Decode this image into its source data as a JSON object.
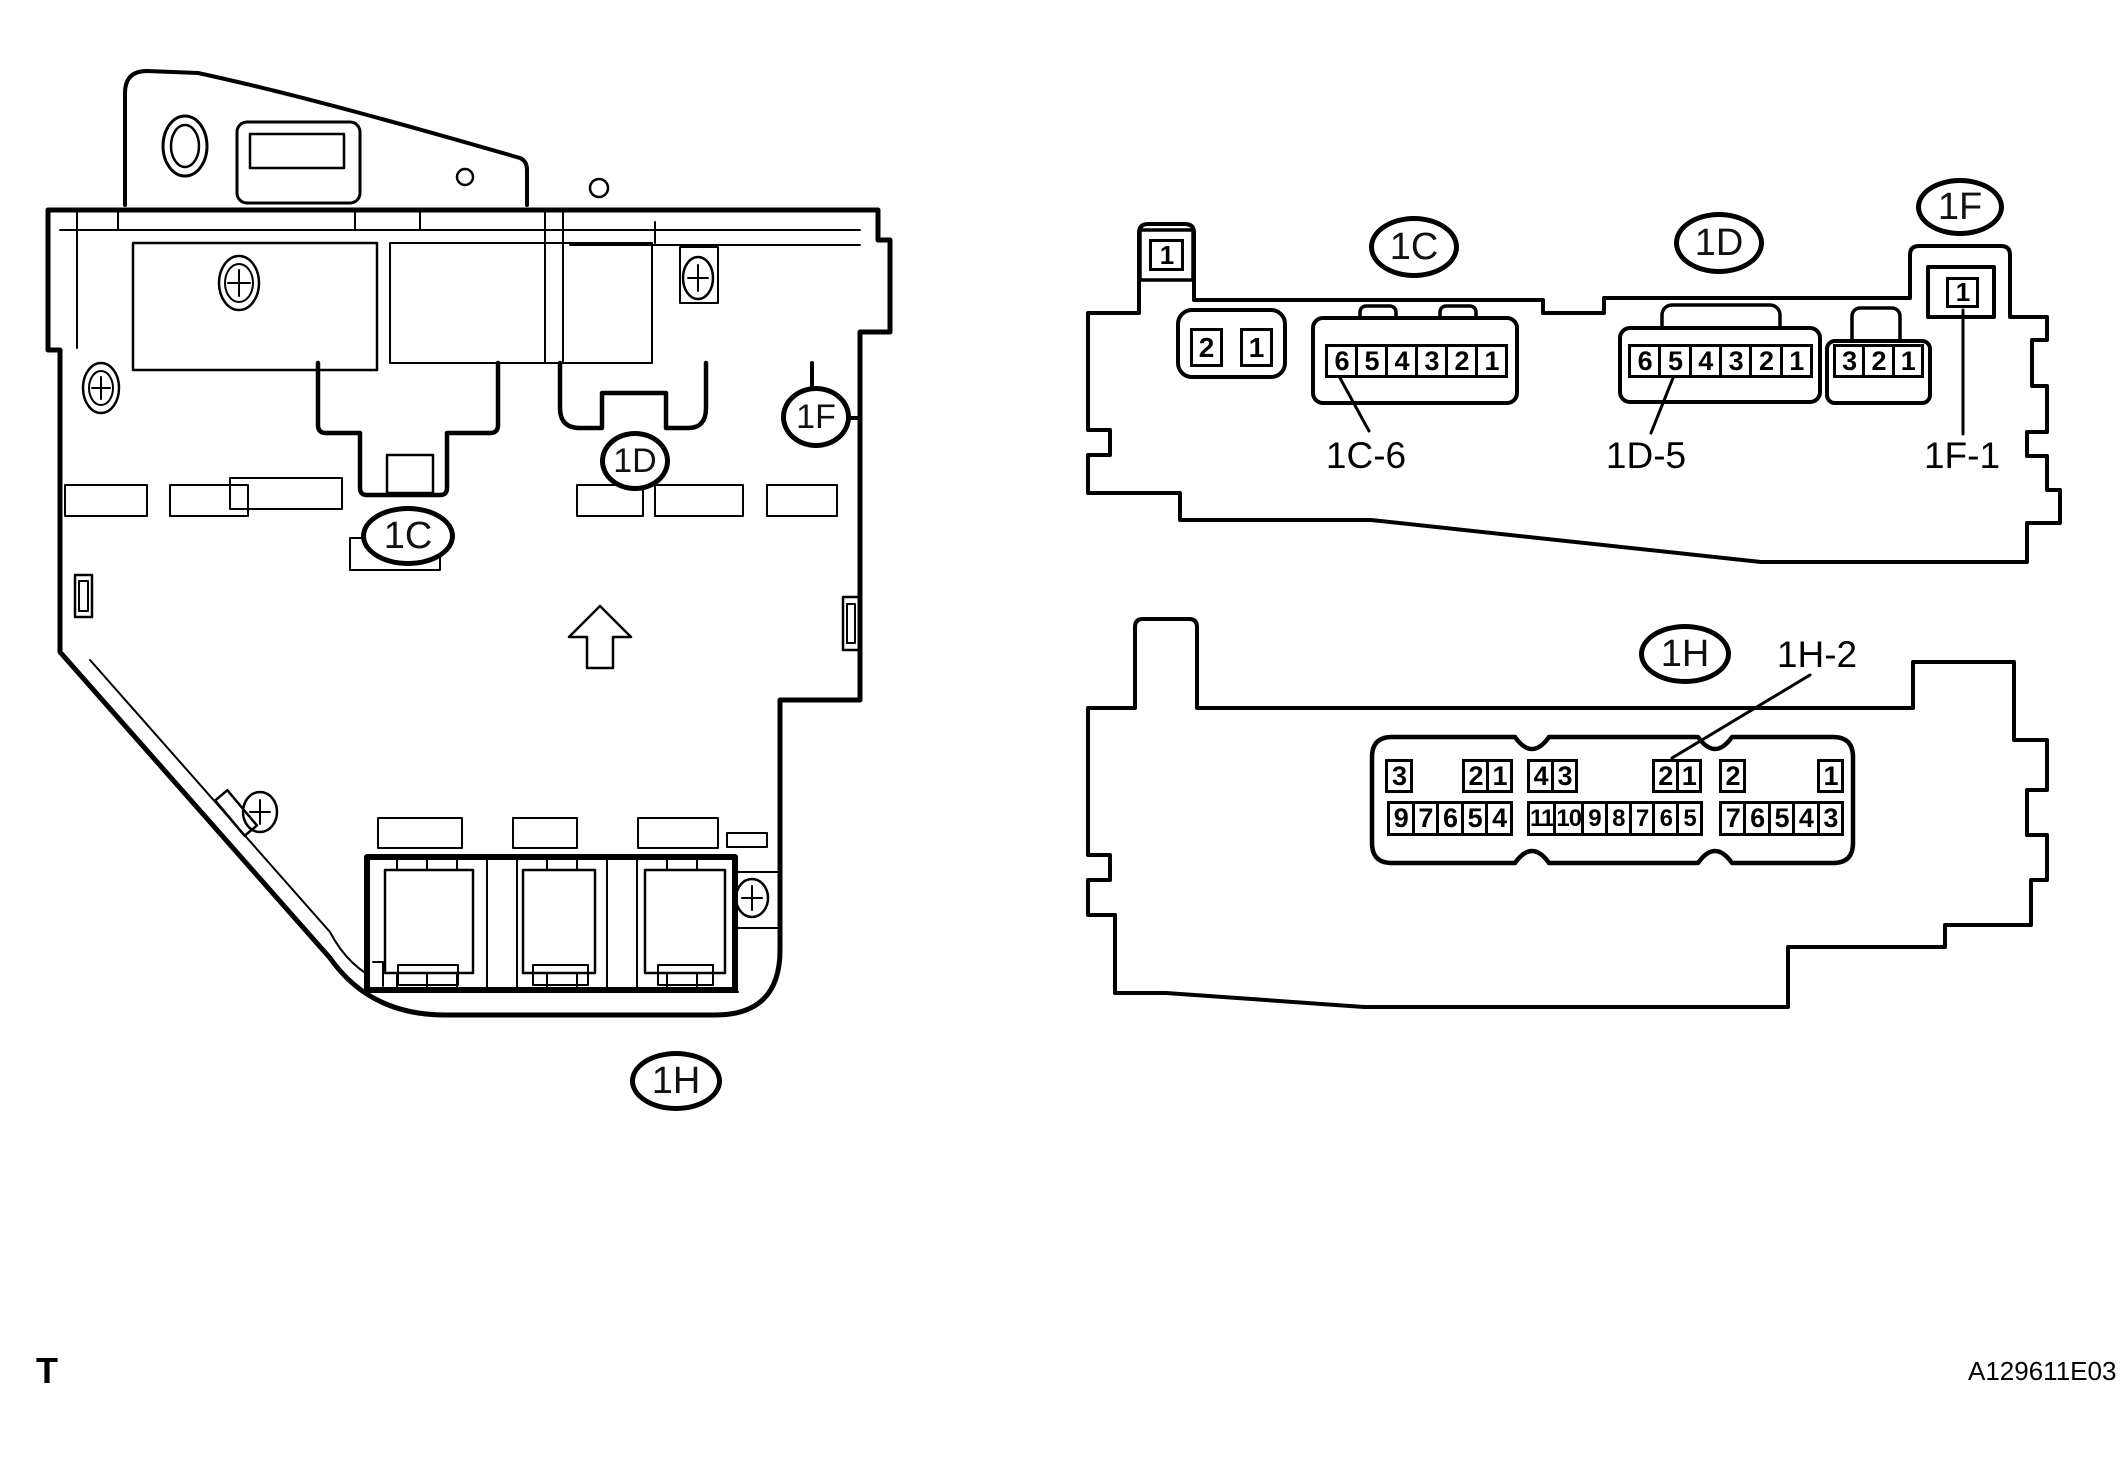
{
  "page": {
    "paper_color": "#ffffff",
    "ink_color": "#000000"
  },
  "footer": {
    "left_mark": "T",
    "figure_code": "A129611E03"
  },
  "box_drawing": {
    "description": "junction-block-side-drawing",
    "up_arrow_icon": "up-arrow",
    "callouts": {
      "c": "1C",
      "d": "1D",
      "f": "1F",
      "h": "1H"
    }
  },
  "top_view": {
    "callouts": {
      "c": "1C",
      "d": "1D",
      "f": "1F"
    },
    "pin_callouts": {
      "c6": "1C-6",
      "d5": "1D-5",
      "f1": "1F-1"
    },
    "connectors": {
      "corner_tab": [
        "1"
      ],
      "pair": [
        "2",
        "1"
      ],
      "c_row": [
        "6",
        "5",
        "4",
        "3",
        "2",
        "1"
      ],
      "d_row": [
        "6",
        "5",
        "4",
        "3",
        "2",
        "1"
      ],
      "triple": [
        "3",
        "2",
        "1"
      ],
      "f_tab": [
        "1"
      ]
    }
  },
  "bottom_view": {
    "callout": "1H",
    "pin_callout": "1H-2",
    "top_row": {
      "g1_single": [
        "3"
      ],
      "g1_pair": [
        "2",
        "1"
      ],
      "g2_pair_a": [
        "4",
        "3"
      ],
      "g2_pair_b": [
        "2",
        "1"
      ],
      "g3_single_a": [
        "2"
      ],
      "g3_single_b": [
        "1"
      ]
    },
    "bottom_row": {
      "g1": [
        "9",
        "7",
        "6",
        "5",
        "4"
      ],
      "g2": [
        "11",
        "10",
        "9",
        "8",
        "7",
        "6",
        "5"
      ],
      "g3": [
        "7",
        "6",
        "5",
        "4",
        "3"
      ]
    }
  }
}
